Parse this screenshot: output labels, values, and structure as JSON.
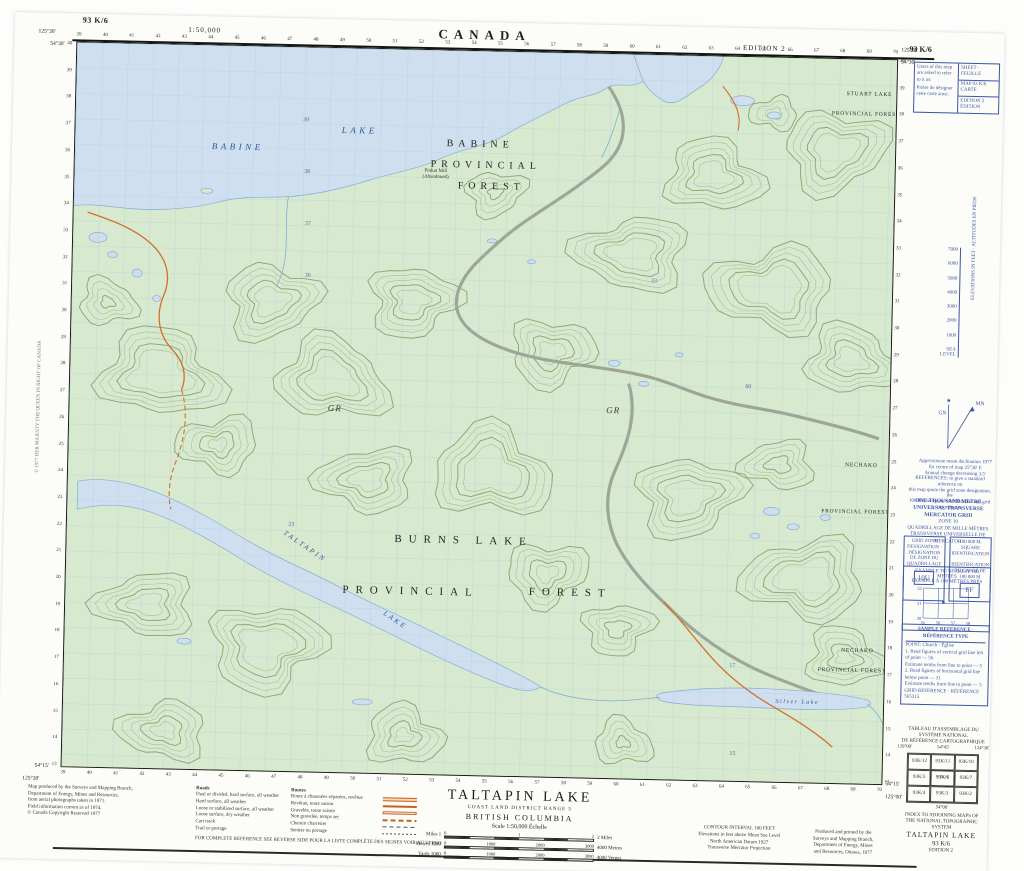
{
  "header": {
    "sheet_no_left": "93 K/6",
    "scale": "1:50,000",
    "country": "CANADA",
    "edition": "EDITION 2",
    "sheet_no_right": "93 K/6"
  },
  "map": {
    "labels": [
      {
        "t": "BABINE",
        "x": 163,
        "y": 104,
        "c": "wl"
      },
      {
        "t": "LAKE",
        "x": 285,
        "y": 85,
        "c": "wl"
      },
      {
        "t": "BABINE",
        "x": 406,
        "y": 96,
        "c": "fl"
      },
      {
        "t": "PROVINCIAL",
        "x": 412,
        "y": 117,
        "c": "fl"
      },
      {
        "t": "FOREST",
        "x": 418,
        "y": 138,
        "c": "fl"
      },
      {
        "t": "STUART LAKE",
        "x": 795,
        "y": 36,
        "c": "fs"
      },
      {
        "t": "PROVINCIAL FOREST",
        "x": 792,
        "y": 56,
        "c": "fs"
      },
      {
        "t": "NECHAKO",
        "x": 795,
        "y": 408,
        "c": "fs"
      },
      {
        "t": "PROVINCIAL FOREST",
        "x": 790,
        "y": 455,
        "c": "fs"
      },
      {
        "t": "NECHAKO",
        "x": 795,
        "y": 594,
        "c": "fs"
      },
      {
        "t": "PROVINCIAL FOREST",
        "x": 790,
        "y": 614,
        "c": "fs"
      },
      {
        "t": "BURNS LAKE",
        "x": 398,
        "y": 494,
        "c": "fl2"
      },
      {
        "t": "PROVINCIAL",
        "x": 346,
        "y": 546,
        "c": "fl2"
      },
      {
        "t": "FOREST",
        "x": 506,
        "y": 544,
        "c": "fl2"
      },
      {
        "t": "TALTAPIN",
        "x": 238,
        "y": 502,
        "c": "wl2",
        "r": 33
      },
      {
        "t": "LAKE",
        "x": 330,
        "y": 574,
        "c": "wl2",
        "r": 33
      },
      {
        "t": "GR",
        "x": 266,
        "y": 364,
        "c": "gr"
      },
      {
        "t": "GR",
        "x": 545,
        "y": 360,
        "c": "gr"
      },
      {
        "t": "Silver  Lake",
        "x": 736,
        "y": 647,
        "c": "ws"
      },
      {
        "t": "Pinkut Mill",
        "x": 362,
        "y": 122,
        "c": "poi"
      },
      {
        "t": "(Abandoned)",
        "x": 362,
        "y": 128,
        "c": "poi"
      }
    ],
    "interior_numbers": [
      {
        "t": "39",
        "x": 231,
        "y": 74
      },
      {
        "t": "38",
        "x": 233,
        "y": 126
      },
      {
        "t": "37",
        "x": 235,
        "y": 178
      },
      {
        "t": "36",
        "x": 236,
        "y": 230
      },
      {
        "t": "33",
        "x": 583,
        "y": 228
      },
      {
        "t": "60",
        "x": 680,
        "y": 332
      },
      {
        "t": "23",
        "x": 225,
        "y": 480
      },
      {
        "t": "17",
        "x": 670,
        "y": 612
      },
      {
        "t": "15",
        "x": 672,
        "y": 700
      }
    ],
    "grid": {
      "eastings_start": 39,
      "eastings_end": 70,
      "northings_top": 40,
      "northings_bottom": 13
    },
    "corners": {
      "nw_lon": "125°30'",
      "nw_lat": "54°30'",
      "ne_lon": "125°00'",
      "ne_lat": "54°30'",
      "sw_lon": "125°30'",
      "sw_lat": "54°15'",
      "se_lon": "125°00'",
      "se_lat": "54°15'"
    }
  },
  "side": {
    "ref_box": {
      "note_en": "Users of this map are asked to refer to it as:",
      "note_fr": "Prière de désigner cette carte ainsi:",
      "rows": [
        "SHEET · FEUILLE",
        "MAP 93 K/6 CARTE",
        "EDITION 2 ÉDITION"
      ]
    },
    "elev_scale": {
      "caption": "ELEVATIONS IN FEET · ALTITUDES EN PIEDS",
      "ticks": [
        "7000",
        "6000",
        "5000",
        "4000",
        "3000",
        "2000",
        "1000",
        "SEA LEVEL"
      ]
    },
    "declination": {
      "gn": "GN",
      "star": "★",
      "mn": "MN",
      "notes": [
        "Approximate mean declination 1977",
        "for centre of map 25°30' E",
        "Annual change decreasing 3.5'"
      ]
    },
    "utm_note": [
      "REFERENCES: to give a standard reference on",
      "this map quote the grid zone designation, the",
      "100 000 m square identification and grid co-ordinates"
    ],
    "utm_block": [
      "ONE THOUSAND METRE",
      "UNIVERSAL TRANSVERSE MERCATOR GRID",
      "ZONE 10",
      "QUADRILLAGE DE MILLE MÈTRES",
      "TRANSVERSE UNIVERSELLE DE MERCATOR"
    ],
    "zone_box": {
      "title": "GRID ZONE DESIGNATION · DÉSIGNATION DE ZONE DU QUADRILLAGE",
      "value": "10U"
    },
    "square_box": {
      "title": "100 000 M. SQUARE IDENTIFICATION · IDENTIFICATION DU CARRÉ DE 100 000 M",
      "value": "FF"
    },
    "example_box": {
      "title1": "EXAMPLE TO NEAREST 100 METRES",
      "title2": "EXEMPLE À 100 MÈTRES PRÈS",
      "x_ticks": [
        "55",
        "56",
        "57",
        "58"
      ],
      "y_ticks": [
        "32",
        "31",
        "30"
      ]
    },
    "sample_box": {
      "title": "SAMPLE REFERENCE · RÉFÉRENCE TYPE",
      "lines": [
        "POINT:  Church · Église",
        "1. Read figures of vertical grid line left of point — 56",
        "    Estimate tenths from line to point — 5",
        "2. Read figures of horizontal grid line below point — 31",
        "    Estimate tenths from line to point — 5",
        "GRID REFERENCE · RÉFÉRENCE  565315"
      ]
    },
    "index": {
      "title_fr1": "TABLEAU D'ASSEMBLAGE DU SYSTÈME NATIONAL",
      "title_fr2": "DE RÉFÉRENCE CARTOGRAPHIQUE",
      "cells": [
        "93K/12",
        "93K/11",
        "93K/10",
        "93K/5",
        "93K/6",
        "93K/7",
        "93K/4",
        "93K/3",
        "93K/2"
      ],
      "center": "93K/6",
      "corner_tl": "126°00'",
      "corner_tr": "124°30'",
      "lat_top": "54°45'",
      "lat_bottom": "54°00'",
      "title_en1": "INDEX TO ADJOINING MAPS OF",
      "title_en2": "THE NATIONAL TOPOGRAPHIC SYSTEM"
    },
    "sheet_id": {
      "name": "TALTAPIN LAKE",
      "number": "93 K/6",
      "edition": "EDITION 2"
    },
    "vertical_note": "© 1977 HER MAJESTY THE QUEEN IN RIGHT OF CANADA"
  },
  "bottom": {
    "credits": [
      "Map produced by the Surveys and Mapping Branch,",
      "Department of Energy, Mines and Resources,",
      "from aerial photographs taken in 1971.",
      "Field information current as of 1974.",
      "© Canada Copyright Reserved 1977"
    ],
    "legend": {
      "head_en": "Roads",
      "head_fr": "Routes",
      "rows": [
        {
          "en": "Dual or divided, hard surface, all weather",
          "fr": "Route à chaussées séparées, revêtue",
          "sym": "s1"
        },
        {
          "en": "Hard surface, all weather",
          "fr": "Revêtue, toute saison",
          "sym": "s2"
        },
        {
          "en": "Loose or stabilized surface, all weather",
          "fr": "Gravelée, toute saison",
          "sym": "s3"
        },
        {
          "en": "Loose surface, dry weather",
          "fr": "Non gravelée, temps sec",
          "sym": "s4"
        },
        {
          "en": "Cart track",
          "fr": "Chemin charretier",
          "sym": "s5"
        },
        {
          "en": "Trail or portage",
          "fr": "Sentier ou portage",
          "sym": "s6"
        }
      ],
      "footer": "FOR COMPLETE REFERENCE SEE REVERSE SIDE      POUR LA LISTE COMPLÈTE DES SIGNES VOIR AU VERSO"
    },
    "title_block": {
      "title": "TALTAPIN LAKE",
      "district": "COAST LAND DISTRICT RANGE 5",
      "province": "BRITISH COLUMBIA",
      "scale_label": "Scale 1:50,000 Échelle"
    },
    "bars": [
      {
        "left": "Miles 1",
        "right": "2 Miles",
        "ticks": [
          "0",
          "1",
          "2"
        ]
      },
      {
        "left": "Metres 1000",
        "right": "4000 Metres",
        "ticks": [
          "0",
          "1000",
          "2000",
          "3000"
        ]
      },
      {
        "left": "Yards 1000",
        "right": "4000 Verges",
        "ticks": [
          "0",
          "1000",
          "2000",
          "3000"
        ]
      }
    ],
    "contour_note": [
      "CONTOUR INTERVAL 100 FEET",
      "Elevations in feet above Mean Sea Level",
      "North American Datum 1927",
      "Transverse Mercator Projection"
    ],
    "production": [
      "Produced and printed by the",
      "Surveys and Mapping Branch,",
      "Department of Energy, Mines",
      "and Resources, Ottawa, 1977"
    ]
  }
}
